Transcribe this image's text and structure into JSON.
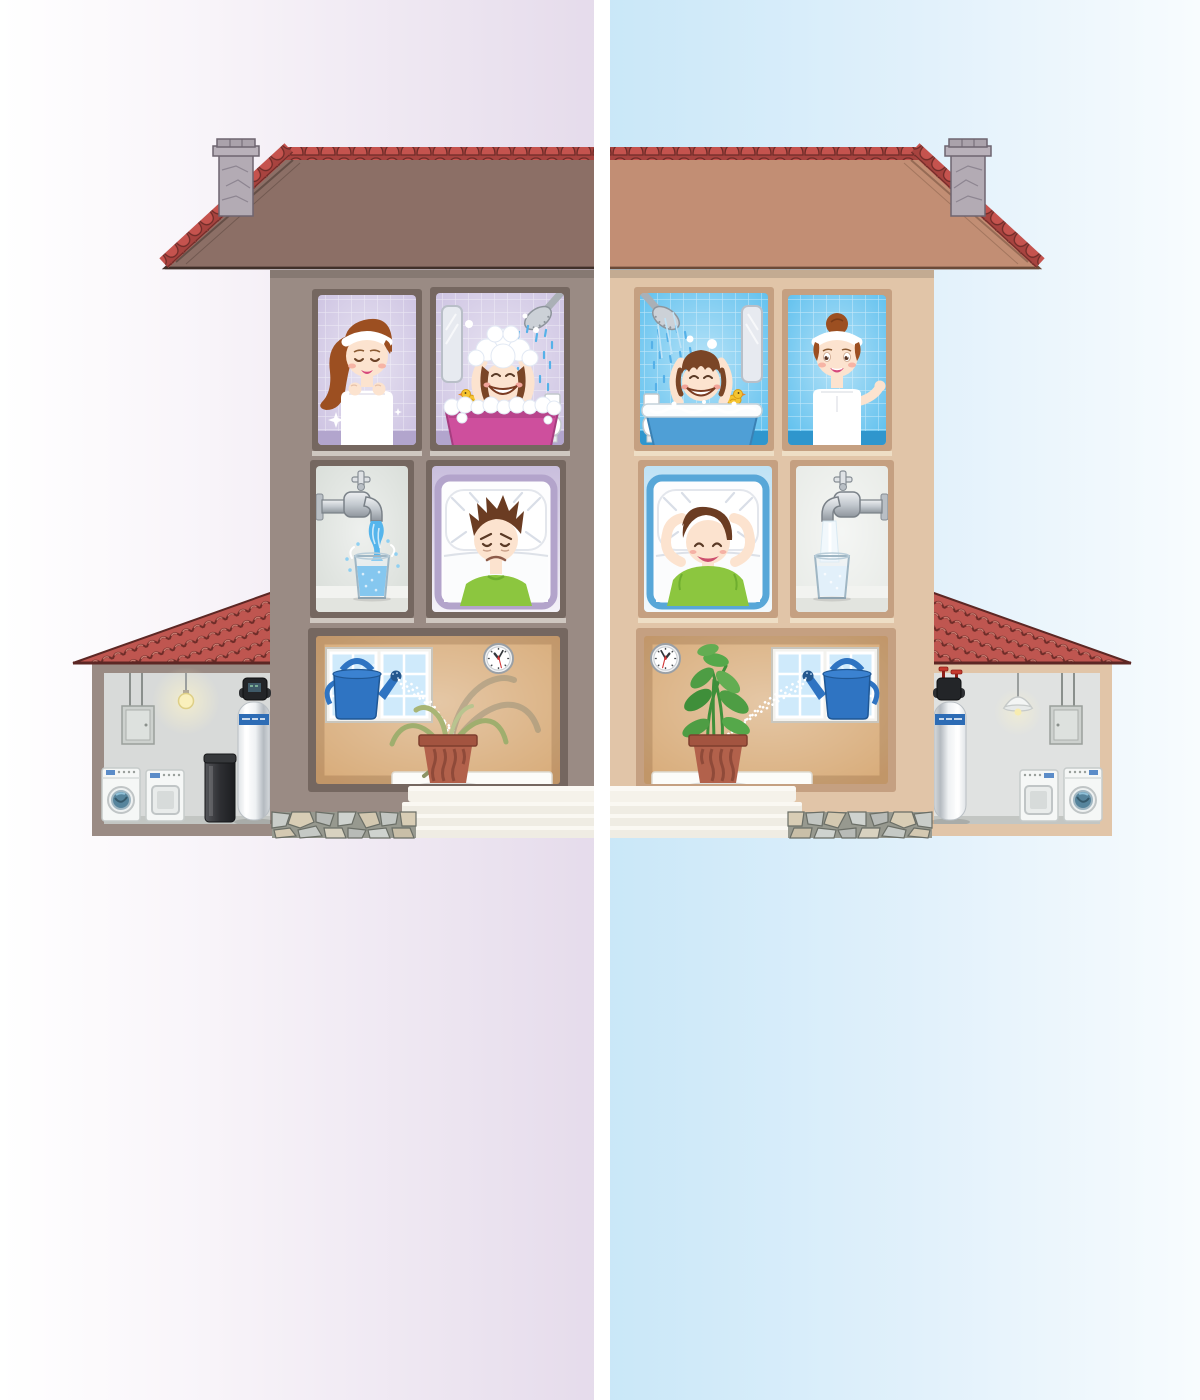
{
  "meta": {
    "description": "Cutaway comparison illustration of a two-story house split down the middle: left half shows an untreated hard-water home on a purple-tinted background, right half shows the same home with a whole-house water filtration system on a blue-tinted background. No visible text appears in the image."
  },
  "divider": {
    "color": "#ffffff"
  },
  "left_half": {
    "background_gradient": [
      "#ffffff",
      "#e5dbeb"
    ],
    "wall_color": "#9a8b84",
    "roof_color": "#8c6f66",
    "bathroom_tile_color": "#cdc3e2",
    "bed_frame_color": "#b3a4cb",
    "scenes": [
      "girl-washing-face",
      "child-bath-excess-soap-foam",
      "faucet-turbulent-hard-water-glass",
      "boy-in-bed-restless-sad",
      "wilted-houseplant-being-watered",
      "garage-with-water-softener-and-brine-tank"
    ]
  },
  "right_half": {
    "background_gradient": [
      "#c9e7f8",
      "#f4fafd"
    ],
    "wall_color": "#e1c5a8",
    "roof_color": "#c28e74",
    "bathroom_tile_color": "#5fc0ee",
    "bed_frame_color": "#58a7d8",
    "scenes": [
      "child-bath-gentle-rinse",
      "girl-in-towel-healthy-hair",
      "boy-in-bed-sleeping-well",
      "faucet-clear-filtered-water-glass",
      "healthy-houseplant-being-watered",
      "garage-with-water-filter-system"
    ]
  },
  "shared_colors": {
    "ridge_tile": "#c5534e",
    "garage_roof_tile": "#bf5650",
    "chimney_stone": "#b3abb4",
    "watering_can": "#2f74c2",
    "plant_pot": "#b2614b",
    "bathtub_left": "#ce4f9d",
    "bathtub_right": "#4f9fd6",
    "shirt_green": "#8cc63f",
    "water_blue": "#52b3ea",
    "tank_label_blue": "#2d6cb5",
    "appliance_white": "#f5f7f6",
    "foundation_stone": "#c9cdc9"
  }
}
